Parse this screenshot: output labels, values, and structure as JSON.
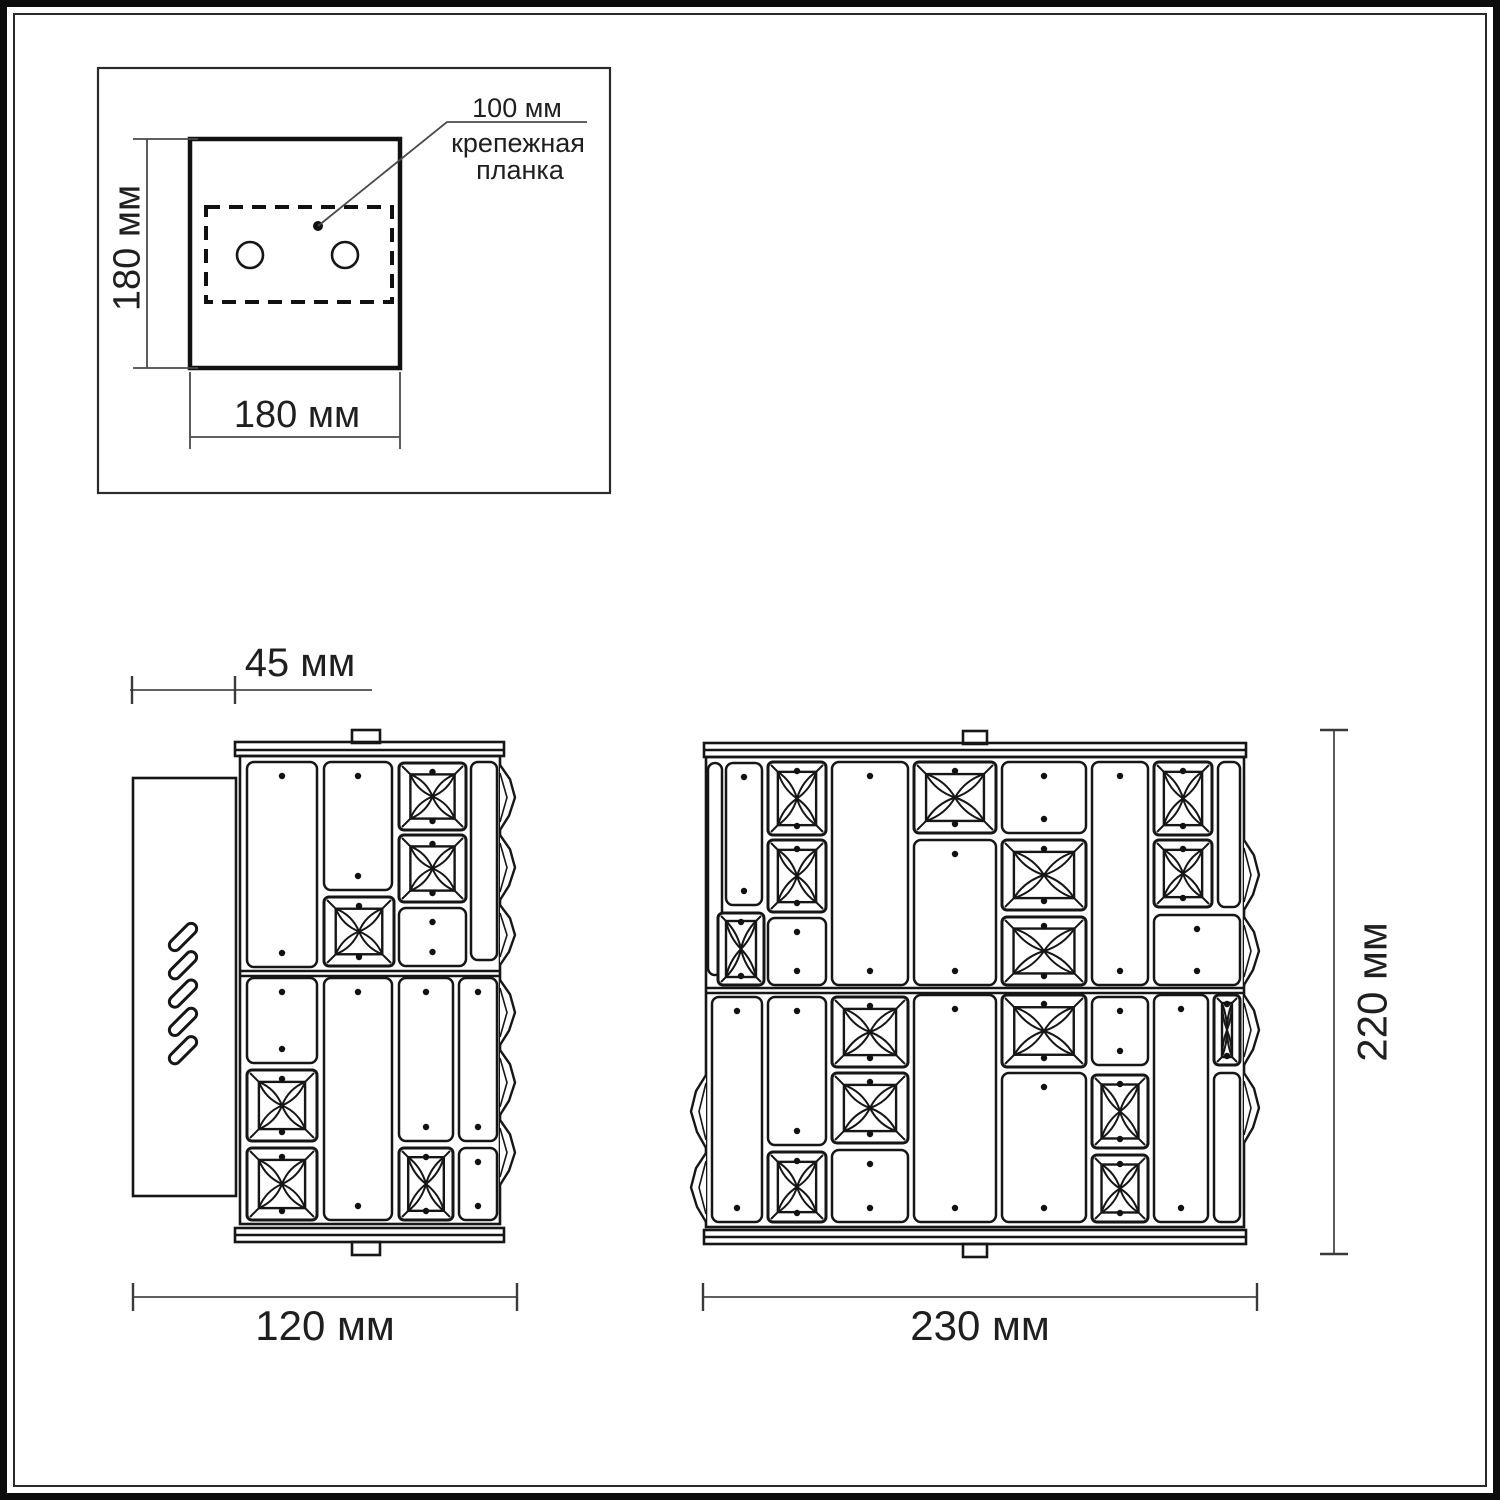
{
  "annotations": {
    "bracket_length": "100 мм",
    "bracket_name_line1": "крепежная",
    "bracket_name_line2": "планка"
  },
  "mounting_plate": {
    "height_label": "180 мм",
    "width_label": "180 мм"
  },
  "side_view": {
    "depth_label": "45 мм",
    "width_label": "120 мм"
  },
  "front_view": {
    "width_label": "230 мм",
    "height_label": "220 мм"
  }
}
